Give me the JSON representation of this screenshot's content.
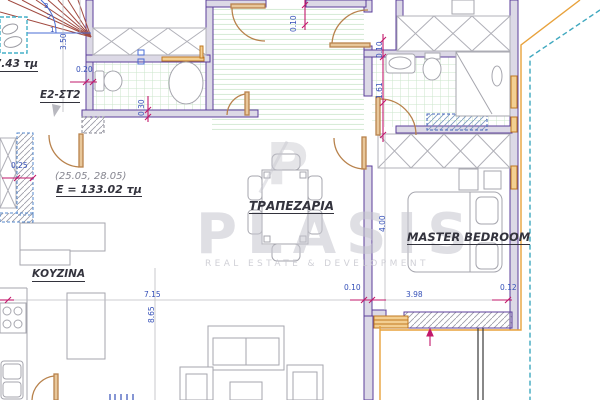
{
  "document": {
    "type": "architectural floor plan"
  },
  "labels": {
    "stair_area": "7.43 τμ",
    "unit": "Ε2-ΣΤ2",
    "coords": "(25.05, 28.05)",
    "total_area": "Ε = 133.02 τμ",
    "dining": "ΤΡΑΠΕΖΑΡΙΑ",
    "master_bedroom": "MASTER BEDROOM",
    "kitchen": "ΚΟΥΖΙΝΑ"
  },
  "stairs": {
    "numbers": [
      "1",
      "2",
      "3"
    ]
  },
  "dimensions": [
    {
      "value": "3.50",
      "orientation": "vertical"
    },
    {
      "value": "0.20",
      "orientation": "horizontal"
    },
    {
      "value": "0.30",
      "orientation": "vertical"
    },
    {
      "value": "0.10",
      "orientation": "vertical"
    },
    {
      "value": "0.10",
      "orientation": "vertical"
    },
    {
      "value": "1.61",
      "orientation": "vertical"
    },
    {
      "value": "4.00",
      "orientation": "vertical"
    },
    {
      "value": "0.25",
      "orientation": "horizontal"
    },
    {
      "value": "7.15",
      "orientation": "horizontal"
    },
    {
      "value": "8.65",
      "orientation": "vertical"
    },
    {
      "value": "0.10",
      "orientation": "horizontal"
    },
    {
      "value": "3.98",
      "orientation": "horizontal"
    },
    {
      "value": "0.12",
      "orientation": "horizontal"
    }
  ],
  "watermark": {
    "brand": "PLASIS",
    "tagline": "REAL ESTATE & DEVELOPMENT",
    "monogram": "P"
  },
  "colors": {
    "wall": "#5b3e9b",
    "door": "#b8824c",
    "dimension_text": "#3550b8",
    "dimension_marks": "#c2186b",
    "tile_grid": "#cbe5cb",
    "boundary": "#3fa8bf",
    "exterior_line": "#e8a23c",
    "stairs": "#a14a40",
    "watermark": "#c6c6ce"
  }
}
